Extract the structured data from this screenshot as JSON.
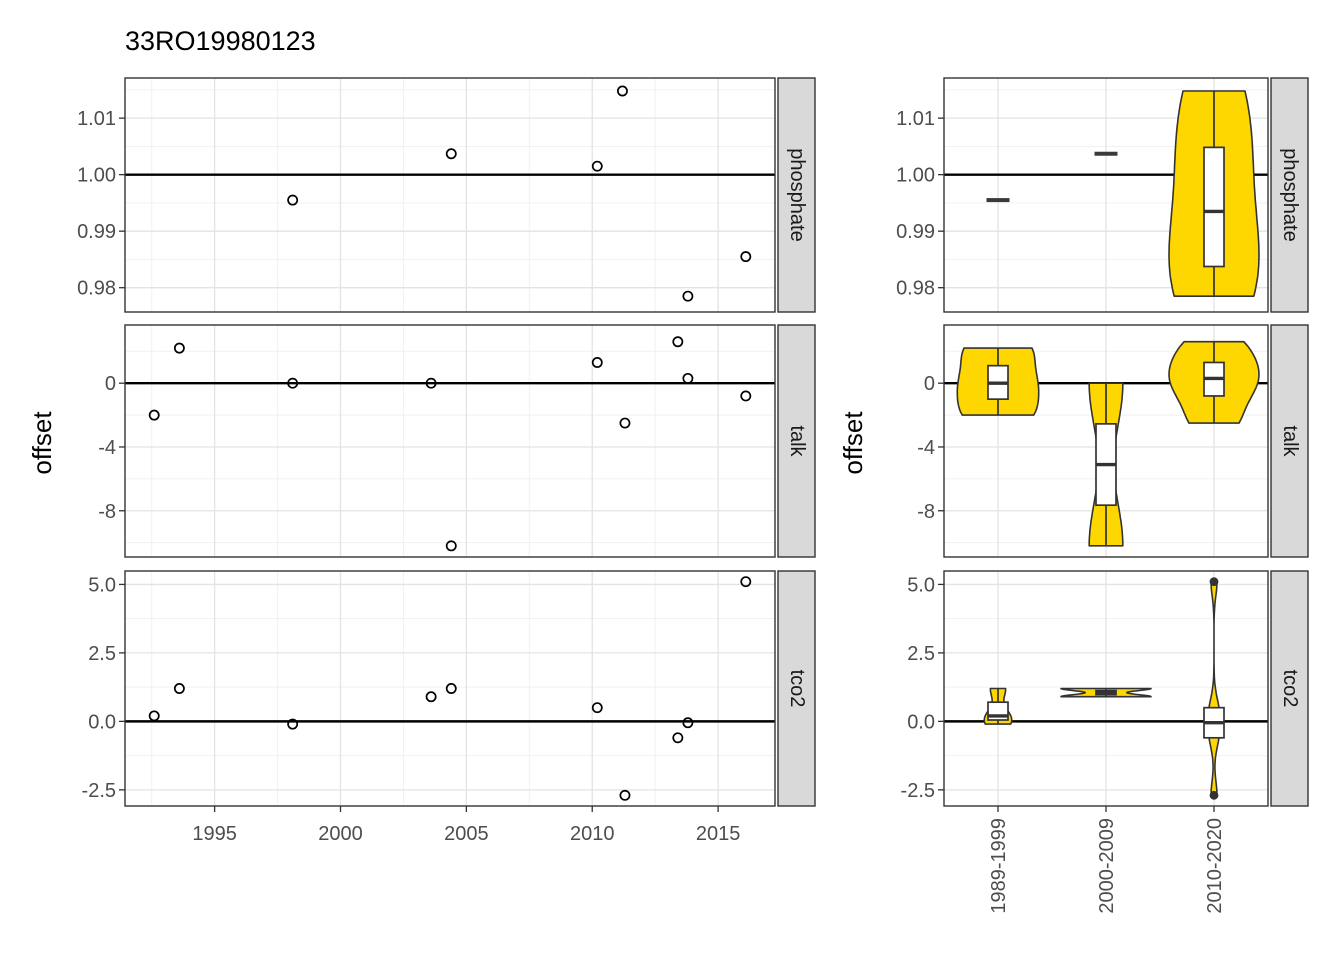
{
  "title": "33RO19980123",
  "y_axis_title": "offset",
  "facets": [
    "phosphate",
    "talk",
    "tco2"
  ],
  "colors": {
    "violin_fill": "#FFD700",
    "strip_bg": "#D9D9D9",
    "grid_major": "#E3E3E3",
    "grid_minor": "#F1F1F1",
    "outline": "#333333",
    "dash": "#3a3a3a",
    "tick_text": "#4D4D4D",
    "title_text": "#000000",
    "ref_line": "#000000",
    "panel_bg": "#FFFFFF",
    "point_stroke": "#000000"
  },
  "chart_data": [
    {
      "type": "scatter",
      "title": "33RO19980123",
      "xlabel": "",
      "ylabel": "offset",
      "grid": true,
      "legend": "none",
      "xlim": [
        1991.44,
        2017.26
      ],
      "x_ticks": {
        "values": [
          1995,
          2000,
          2005,
          2010,
          2015
        ],
        "labels": [
          "1995",
          "2000",
          "2005",
          "2010",
          "2015"
        ]
      },
      "x_minor": [
        1992.5,
        1997.5,
        2002.5,
        2007.5,
        2012.5
      ],
      "panels": [
        {
          "facet": "phosphate",
          "ylim": [
            0.9757,
            1.0171
          ],
          "ref_line": 1.0,
          "y_ticks": {
            "values": [
              1.01,
              1.0,
              0.99,
              0.98
            ],
            "labels": [
              "1.01",
              "1.00",
              "0.99",
              "0.98"
            ]
          },
          "y_minor": [
            1.015,
            1.005,
            0.995,
            0.985
          ],
          "points": [
            [
              1998.1,
              0.9955
            ],
            [
              2004.4,
              1.0037
            ],
            [
              2010.2,
              1.0015
            ],
            [
              2011.2,
              1.0148
            ],
            [
              2013.8,
              0.9785
            ],
            [
              2016.1,
              0.9855
            ]
          ]
        },
        {
          "facet": "talk",
          "ylim": [
            -10.9,
            3.65
          ],
          "ref_line": 0,
          "y_ticks": {
            "values": [
              0,
              -4,
              -8
            ],
            "labels": [
              "0",
              "-4",
              "-8"
            ]
          },
          "y_minor": [
            2,
            -2,
            -6,
            -10
          ],
          "points": [
            [
              1992.6,
              -2.0
            ],
            [
              1993.6,
              2.2
            ],
            [
              1998.1,
              0.0
            ],
            [
              2003.6,
              0.0
            ],
            [
              2004.4,
              -10.2
            ],
            [
              2010.2,
              1.3
            ],
            [
              2011.3,
              -2.5
            ],
            [
              2013.4,
              2.6
            ],
            [
              2013.8,
              0.3
            ],
            [
              2016.1,
              -0.8
            ]
          ]
        },
        {
          "facet": "tco2",
          "ylim": [
            -3.09,
            5.49
          ],
          "ref_line": 0,
          "y_ticks": {
            "values": [
              5.0,
              2.5,
              0.0,
              -2.5
            ],
            "labels": [
              "5.0",
              "2.5",
              "0.0",
              "-2.5"
            ]
          },
          "y_minor": [
            3.75,
            1.25,
            -1.25
          ],
          "points": [
            [
              1992.6,
              0.2
            ],
            [
              1993.6,
              1.2
            ],
            [
              1998.1,
              -0.1
            ],
            [
              2003.6,
              0.9
            ],
            [
              2004.4,
              1.2
            ],
            [
              2010.2,
              0.5
            ],
            [
              2011.3,
              -2.7
            ],
            [
              2013.4,
              -0.6
            ],
            [
              2013.8,
              -0.05
            ],
            [
              2016.1,
              5.1
            ]
          ]
        }
      ]
    },
    {
      "type": "violin",
      "ylabel": "offset",
      "grid": true,
      "legend": "none",
      "categories": [
        "1989-1999",
        "2000-2009",
        "2010-2020"
      ],
      "panels": [
        {
          "facet": "phosphate",
          "groups": [
            {
              "category": "1989-1999",
              "values": [
                0.9955
              ]
            },
            {
              "category": "2000-2009",
              "values": [
                1.0037
              ]
            },
            {
              "category": "2010-2020",
              "values": [
                1.0015,
                1.0148,
                0.9785,
                0.9855
              ]
            }
          ]
        },
        {
          "facet": "talk",
          "groups": [
            {
              "category": "1989-1999",
              "values": [
                -2.0,
                2.2,
                0.0
              ]
            },
            {
              "category": "2000-2009",
              "values": [
                0.0,
                -10.2
              ]
            },
            {
              "category": "2010-2020",
              "values": [
                1.3,
                -2.5,
                2.6,
                0.3,
                -0.8
              ]
            }
          ]
        },
        {
          "facet": "tco2",
          "groups": [
            {
              "category": "1989-1999",
              "values": [
                0.2,
                1.2,
                -0.1
              ]
            },
            {
              "category": "2000-2009",
              "values": [
                0.9,
                1.2
              ]
            },
            {
              "category": "2010-2020",
              "values": [
                0.5,
                -2.7,
                -0.6,
                -0.05,
                5.1
              ]
            }
          ]
        }
      ]
    }
  ]
}
